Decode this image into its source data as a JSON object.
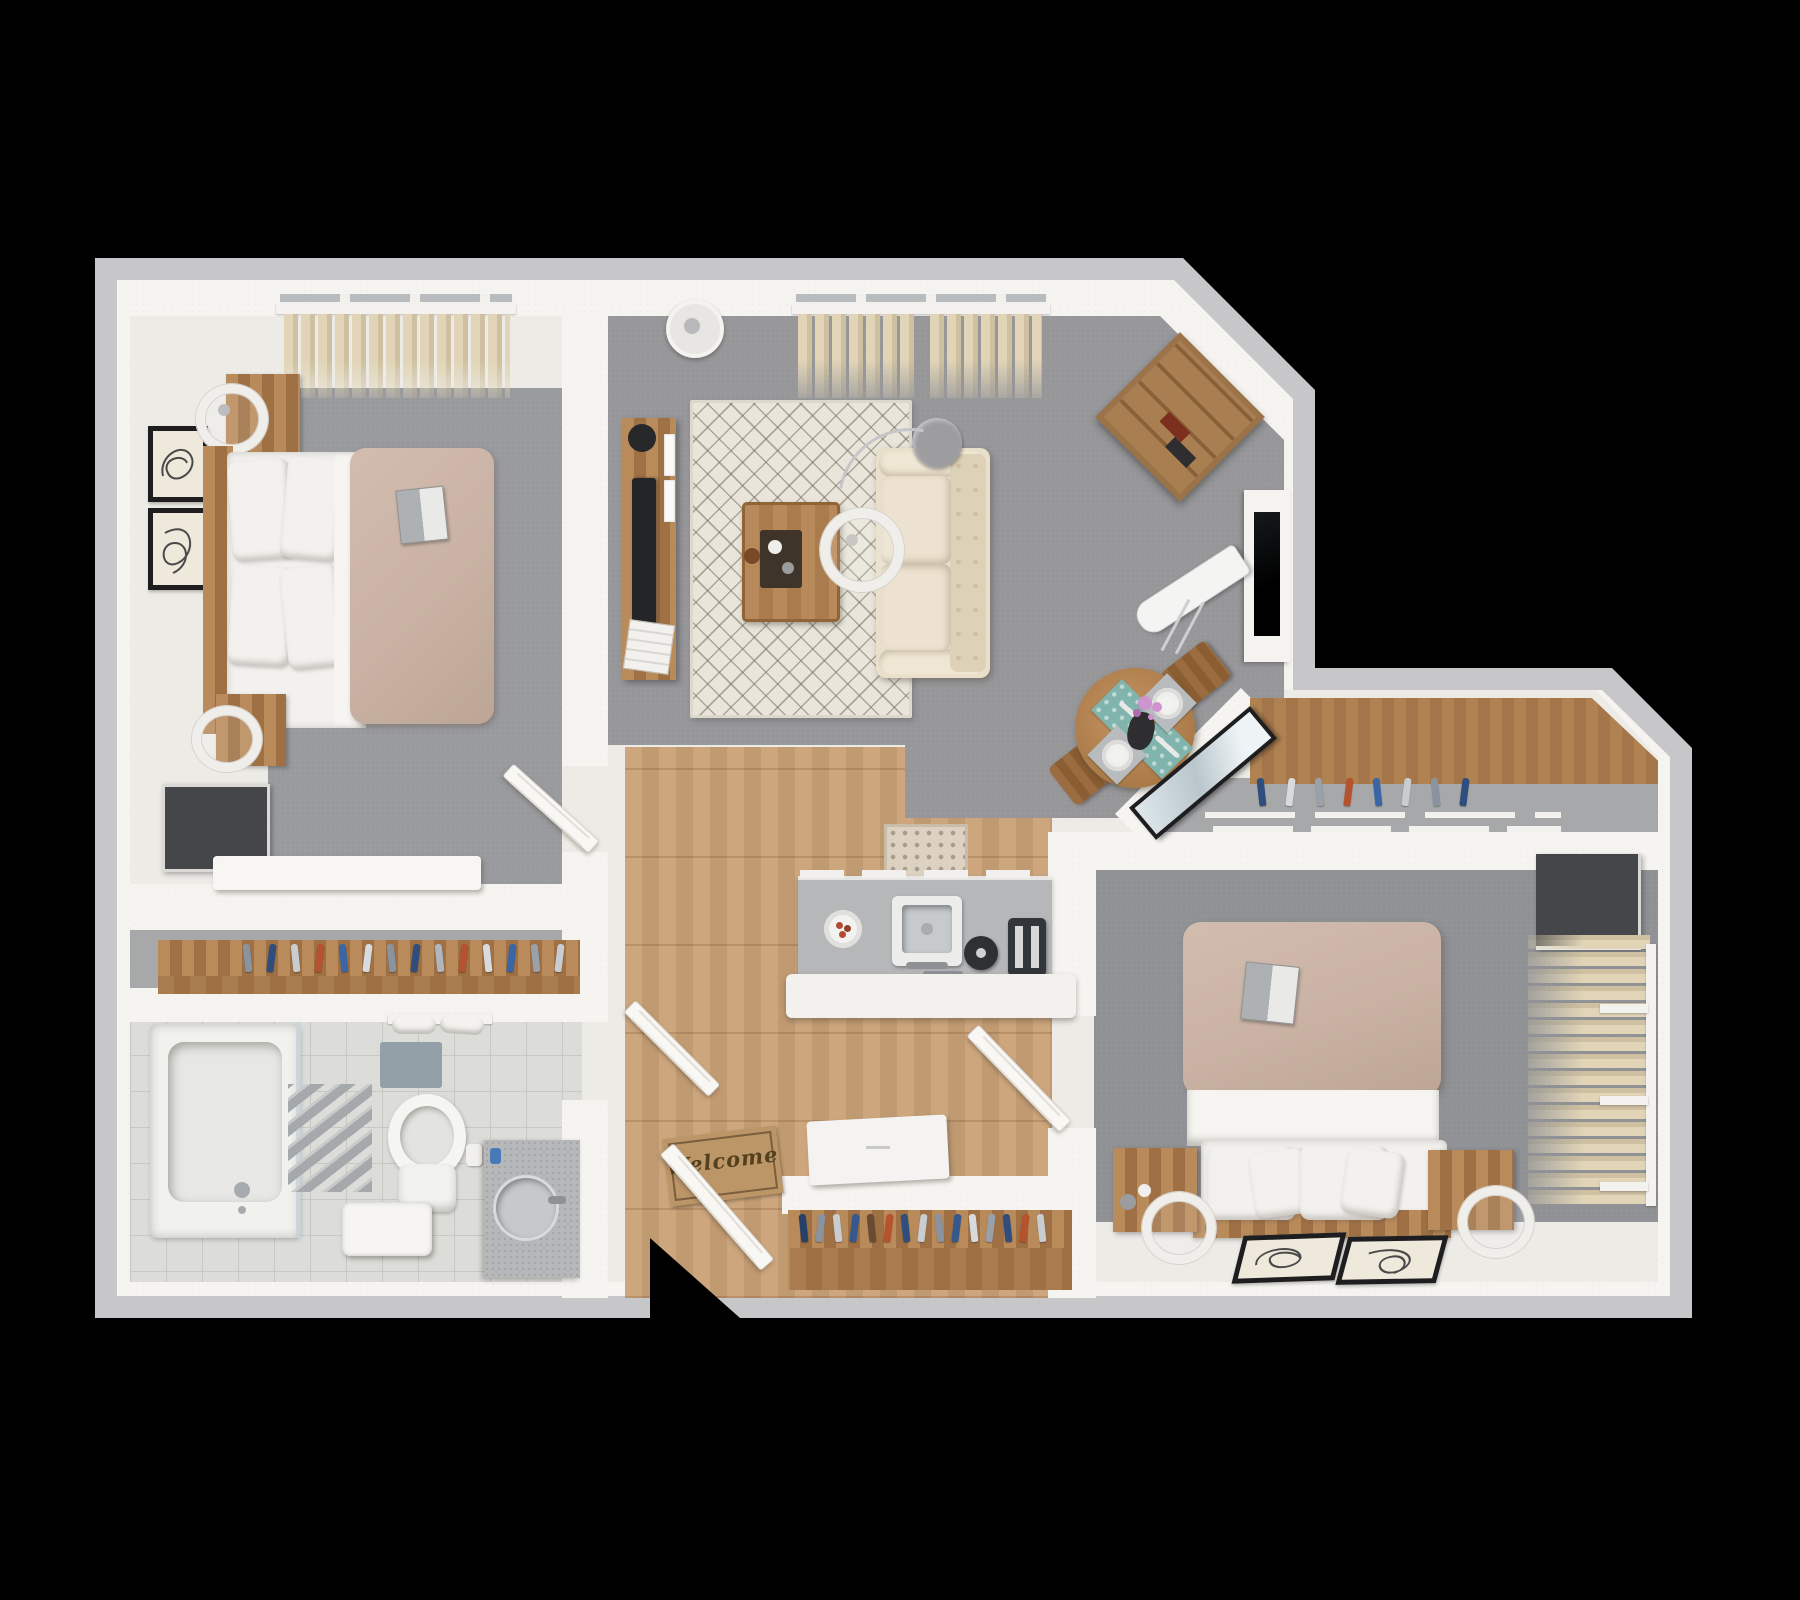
{
  "scene": {
    "type": "3d-floor-plan-render",
    "rooms": [
      {
        "name": "bedroom-1"
      },
      {
        "name": "living-room"
      },
      {
        "name": "dining-area"
      },
      {
        "name": "kitchen"
      },
      {
        "name": "bathroom"
      },
      {
        "name": "hallway"
      },
      {
        "name": "entry"
      },
      {
        "name": "walk-in-closet"
      },
      {
        "name": "bedroom-2"
      }
    ]
  },
  "entry": {
    "welcome_mat_text": "Welcome"
  },
  "palette": {
    "outer_band": "#c7c7c9",
    "wall": "#f6f4f0",
    "floor_light": "#edebe6",
    "carpet_living": "#97979a",
    "carpet_bed1": "#999a9d",
    "carpet_bed2": "#8f9194",
    "closet_floor": "#a7a8aa",
    "wood_floor_1": "#cda67d",
    "wood_floor_2": "#c09a71",
    "furniture_wood": "#b98a5a",
    "furniture_wood_dark": "#9e7044",
    "wood_front": "#a87c4f",
    "duvet": "#c9b2a3",
    "linen_white": "#f2f1ee",
    "sofa_cream": "#e9dfcb",
    "sofa_cream_dark": "#ddd1b7",
    "rug_cream": "#e9e5da",
    "rug_line": "#6e6858",
    "counter_gray": "#b5b7b9",
    "steel": "#8e9295",
    "appliance_dark": "#303338",
    "tile": "#dcdcd8",
    "tile_line": "#c7c7c3",
    "curtain_1": "#e1d4b7",
    "curtain_2": "#cec0a0",
    "teal_mat": "#80b4ac",
    "flower_pink": "#cf93cf",
    "frame_dark": "#1e1e20",
    "glass_blue": "#c9d4da",
    "door_white": "#f8f7f4",
    "mat_tan": "#bd9668",
    "mat_text": "#53401f",
    "radiator_gray": "#a6a9ab",
    "tv_dark": "#44464a",
    "lamp_white": "#efeeea"
  },
  "closets": {
    "bedroom1": {
      "colors": [
        "#8a93a0",
        "#2f4e7d",
        "#c8cdd2",
        "#b5532f",
        "#3b66a6",
        "#d8dbde",
        "#8a93a0",
        "#2f4e7d",
        "#b0b6bd",
        "#b5532f",
        "#d8dbde",
        "#3b66a6",
        "#9aa1a8",
        "#c8cdd2"
      ]
    },
    "entry": {
      "colors": [
        "#27406b",
        "#8a93a0",
        "#c8cdd2",
        "#35588f",
        "#6b4a33",
        "#b5532f",
        "#2f4e7d",
        "#c8cdd2",
        "#8a93a0",
        "#35588f",
        "#d8dbde",
        "#9aa1a8",
        "#2f4e7d",
        "#b5532f",
        "#c8cdd2"
      ]
    },
    "hall": {
      "colors": [
        "#2f4e7d",
        "#d8dbde",
        "#9aa1a8",
        "#b5532f",
        "#3b66a6",
        "#c8cdd2",
        "#8a93a0",
        "#2f4e7d"
      ]
    }
  }
}
